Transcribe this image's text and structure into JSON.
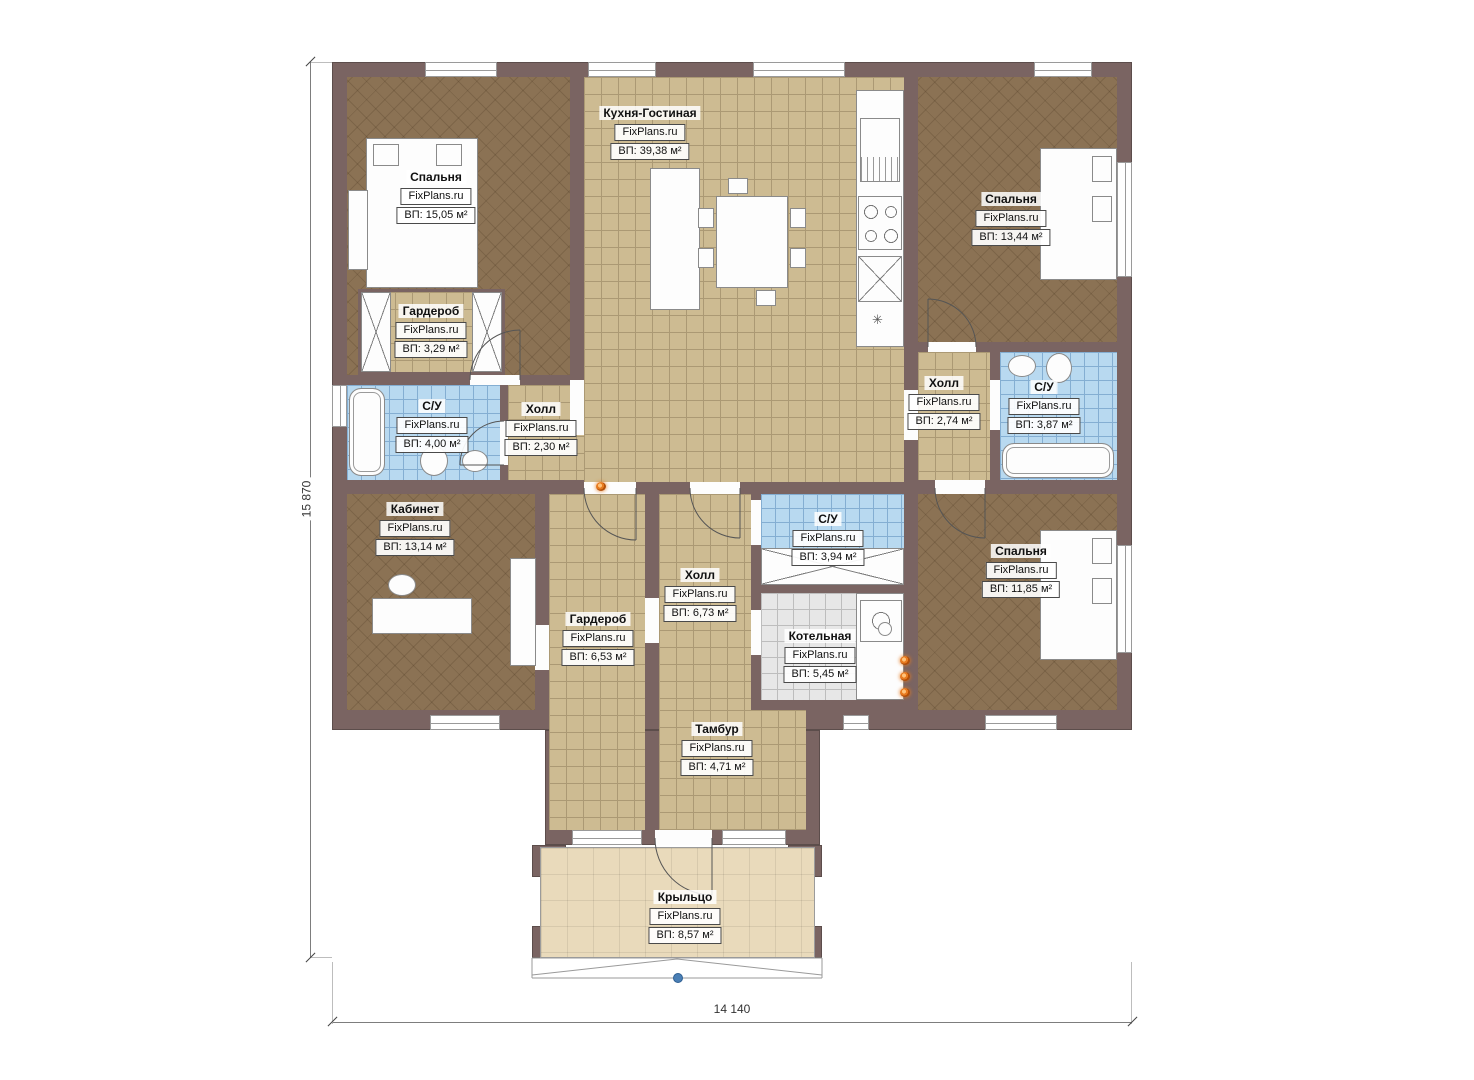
{
  "watermark": "FixPlans.ru",
  "dimensions": {
    "height_label": "15 870",
    "width_label": "14 140"
  },
  "rooms": [
    {
      "name": "Кухня-Гостиная",
      "area": "ВП: 39,38 м²"
    },
    {
      "name": "Спальня",
      "area": "ВП: 15,05 м²"
    },
    {
      "name": "Спальня",
      "area": "ВП: 13,44 м²"
    },
    {
      "name": "Гардероб",
      "area": "ВП: 3,29 м²"
    },
    {
      "name": "С/У",
      "area": "ВП: 4,00 м²"
    },
    {
      "name": "Холл",
      "area": "ВП: 2,30 м²"
    },
    {
      "name": "Холл",
      "area": "ВП: 2,74 м²"
    },
    {
      "name": "С/У",
      "area": "ВП: 3,87 м²"
    },
    {
      "name": "Кабинет",
      "area": "ВП: 13,14 м²"
    },
    {
      "name": "С/У",
      "area": "ВП: 3,94 м²"
    },
    {
      "name": "Холл",
      "area": "ВП: 6,73 м²"
    },
    {
      "name": "Гардероб",
      "area": "ВП: 6,53 м²"
    },
    {
      "name": "Котельная",
      "area": "ВП: 5,45 м²"
    },
    {
      "name": "Спальня",
      "area": "ВП: 11,85 м²"
    },
    {
      "name": "Тамбур",
      "area": "ВП: 4,71 м²"
    },
    {
      "name": "Крыльцо",
      "area": "ВП: 8,57 м²"
    }
  ],
  "misc": {
    "kitchen_marker": "✳"
  },
  "colors": {
    "wall": "#7a6462",
    "floor_tan": "#cdbb92",
    "floor_dark": "#8b7254",
    "floor_wet": "#b8d9f0",
    "floor_boiler": "#e7e7e7",
    "floor_porch": "#e9dabb",
    "outlet_orange": "#e87b20",
    "marker_blue": "#4a7fb5"
  }
}
